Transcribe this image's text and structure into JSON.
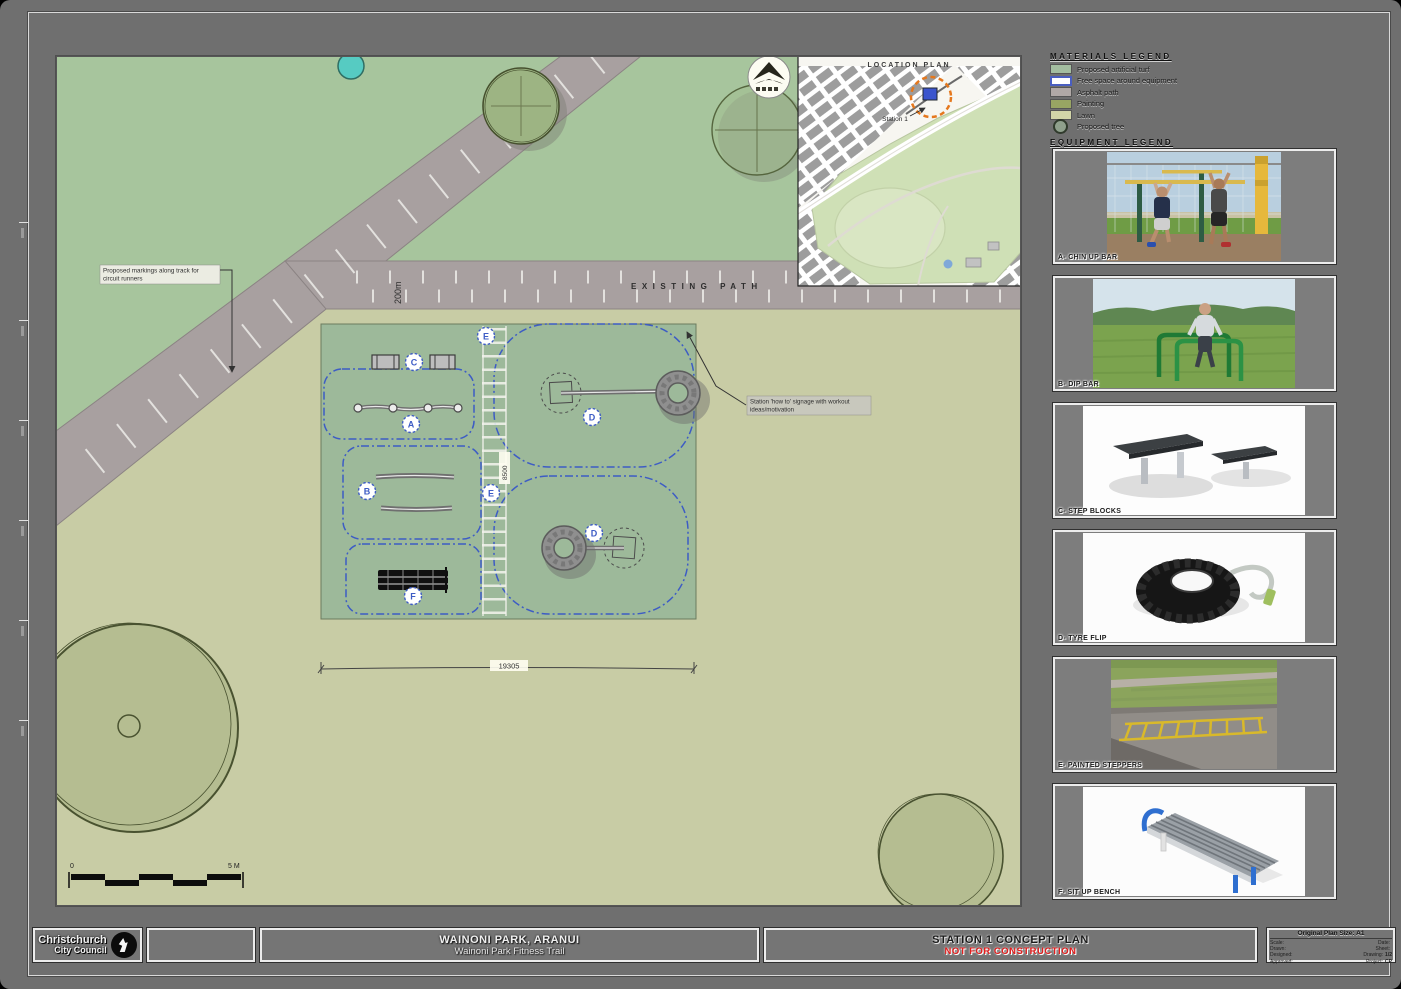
{
  "colors": {
    "lawn": "#c8cca5",
    "green_area": "#a7c59d",
    "asphalt": "#a8a0a0",
    "turf": "#9db99a",
    "free_space_blue": "#3d5cc5",
    "status_red": "#e01d1d",
    "location_marker_orange": "#e5781e"
  },
  "materials_legend": {
    "title": "MATERIALS LEGEND",
    "items": [
      {
        "label": "Proposed artificial turf",
        "color": "#a3bda0"
      },
      {
        "label": "Free space around equipment",
        "color": "#ffffff"
      },
      {
        "label": "Asphalt path",
        "color": "#b0a8a6"
      },
      {
        "label": "Painting",
        "color": "#98a563"
      },
      {
        "label": "Lawn",
        "color": "#d2d5a8"
      },
      {
        "label": "Proposed tree",
        "color": "#8fa08c"
      }
    ]
  },
  "equipment_legend": {
    "title": "EQUIPMENT LEGEND",
    "panels": [
      {
        "id": "A",
        "label": "A- CHIN UP BAR"
      },
      {
        "id": "B",
        "label": "B- DIP BAR"
      },
      {
        "id": "C",
        "label": "C- STEP BLOCKS"
      },
      {
        "id": "D",
        "label": "D- TYRE FLIP"
      },
      {
        "id": "E",
        "label": "E- PAINTED STEPPERS"
      },
      {
        "id": "F",
        "label": "F- SIT UP BENCH"
      }
    ]
  },
  "location_plan": {
    "title": "LOCATION PLAN",
    "station_label": "Station 1"
  },
  "plan": {
    "existing_path_label": "EXISTING PATH",
    "track_distance": "200m",
    "note_markings_line1": "Proposed markings along track for",
    "note_markings_line2": "circuit runners",
    "note_signage_line1": "Station 'how to' signage with workout",
    "note_signage_line2": "ideas/motivation",
    "dim_width": "19305",
    "dim_height": "8500",
    "scale_zero": "0",
    "scale_end": "5 M",
    "marker_letters": [
      "E",
      "C",
      "A",
      "B",
      "F",
      "D",
      "E",
      "D"
    ]
  },
  "title_block": {
    "logo_line1": "Christchurch",
    "logo_line2": "City Council",
    "project_name": "WAINONI PARK, ARANUI",
    "project_subtitle": "Wainoni Park Fitness Trail",
    "sheet_title": "STATION 1 CONCEPT PLAN",
    "status": "NOT FOR CONSTRUCTION",
    "info": {
      "size_label": "Original Plan Size: A1",
      "rows": [
        {
          "l": "Scale:",
          "lv": "",
          "r": "Date:",
          "rv": ""
        },
        {
          "l": "Drawn:",
          "lv": "",
          "r": "Sheet:",
          "rv": ""
        },
        {
          "l": "Designed:",
          "lv": "",
          "r": "Drawing:",
          "rv": "1/2"
        },
        {
          "l": "Approved:",
          "lv": "",
          "r": "Project:",
          "rv": "CP"
        }
      ]
    }
  }
}
